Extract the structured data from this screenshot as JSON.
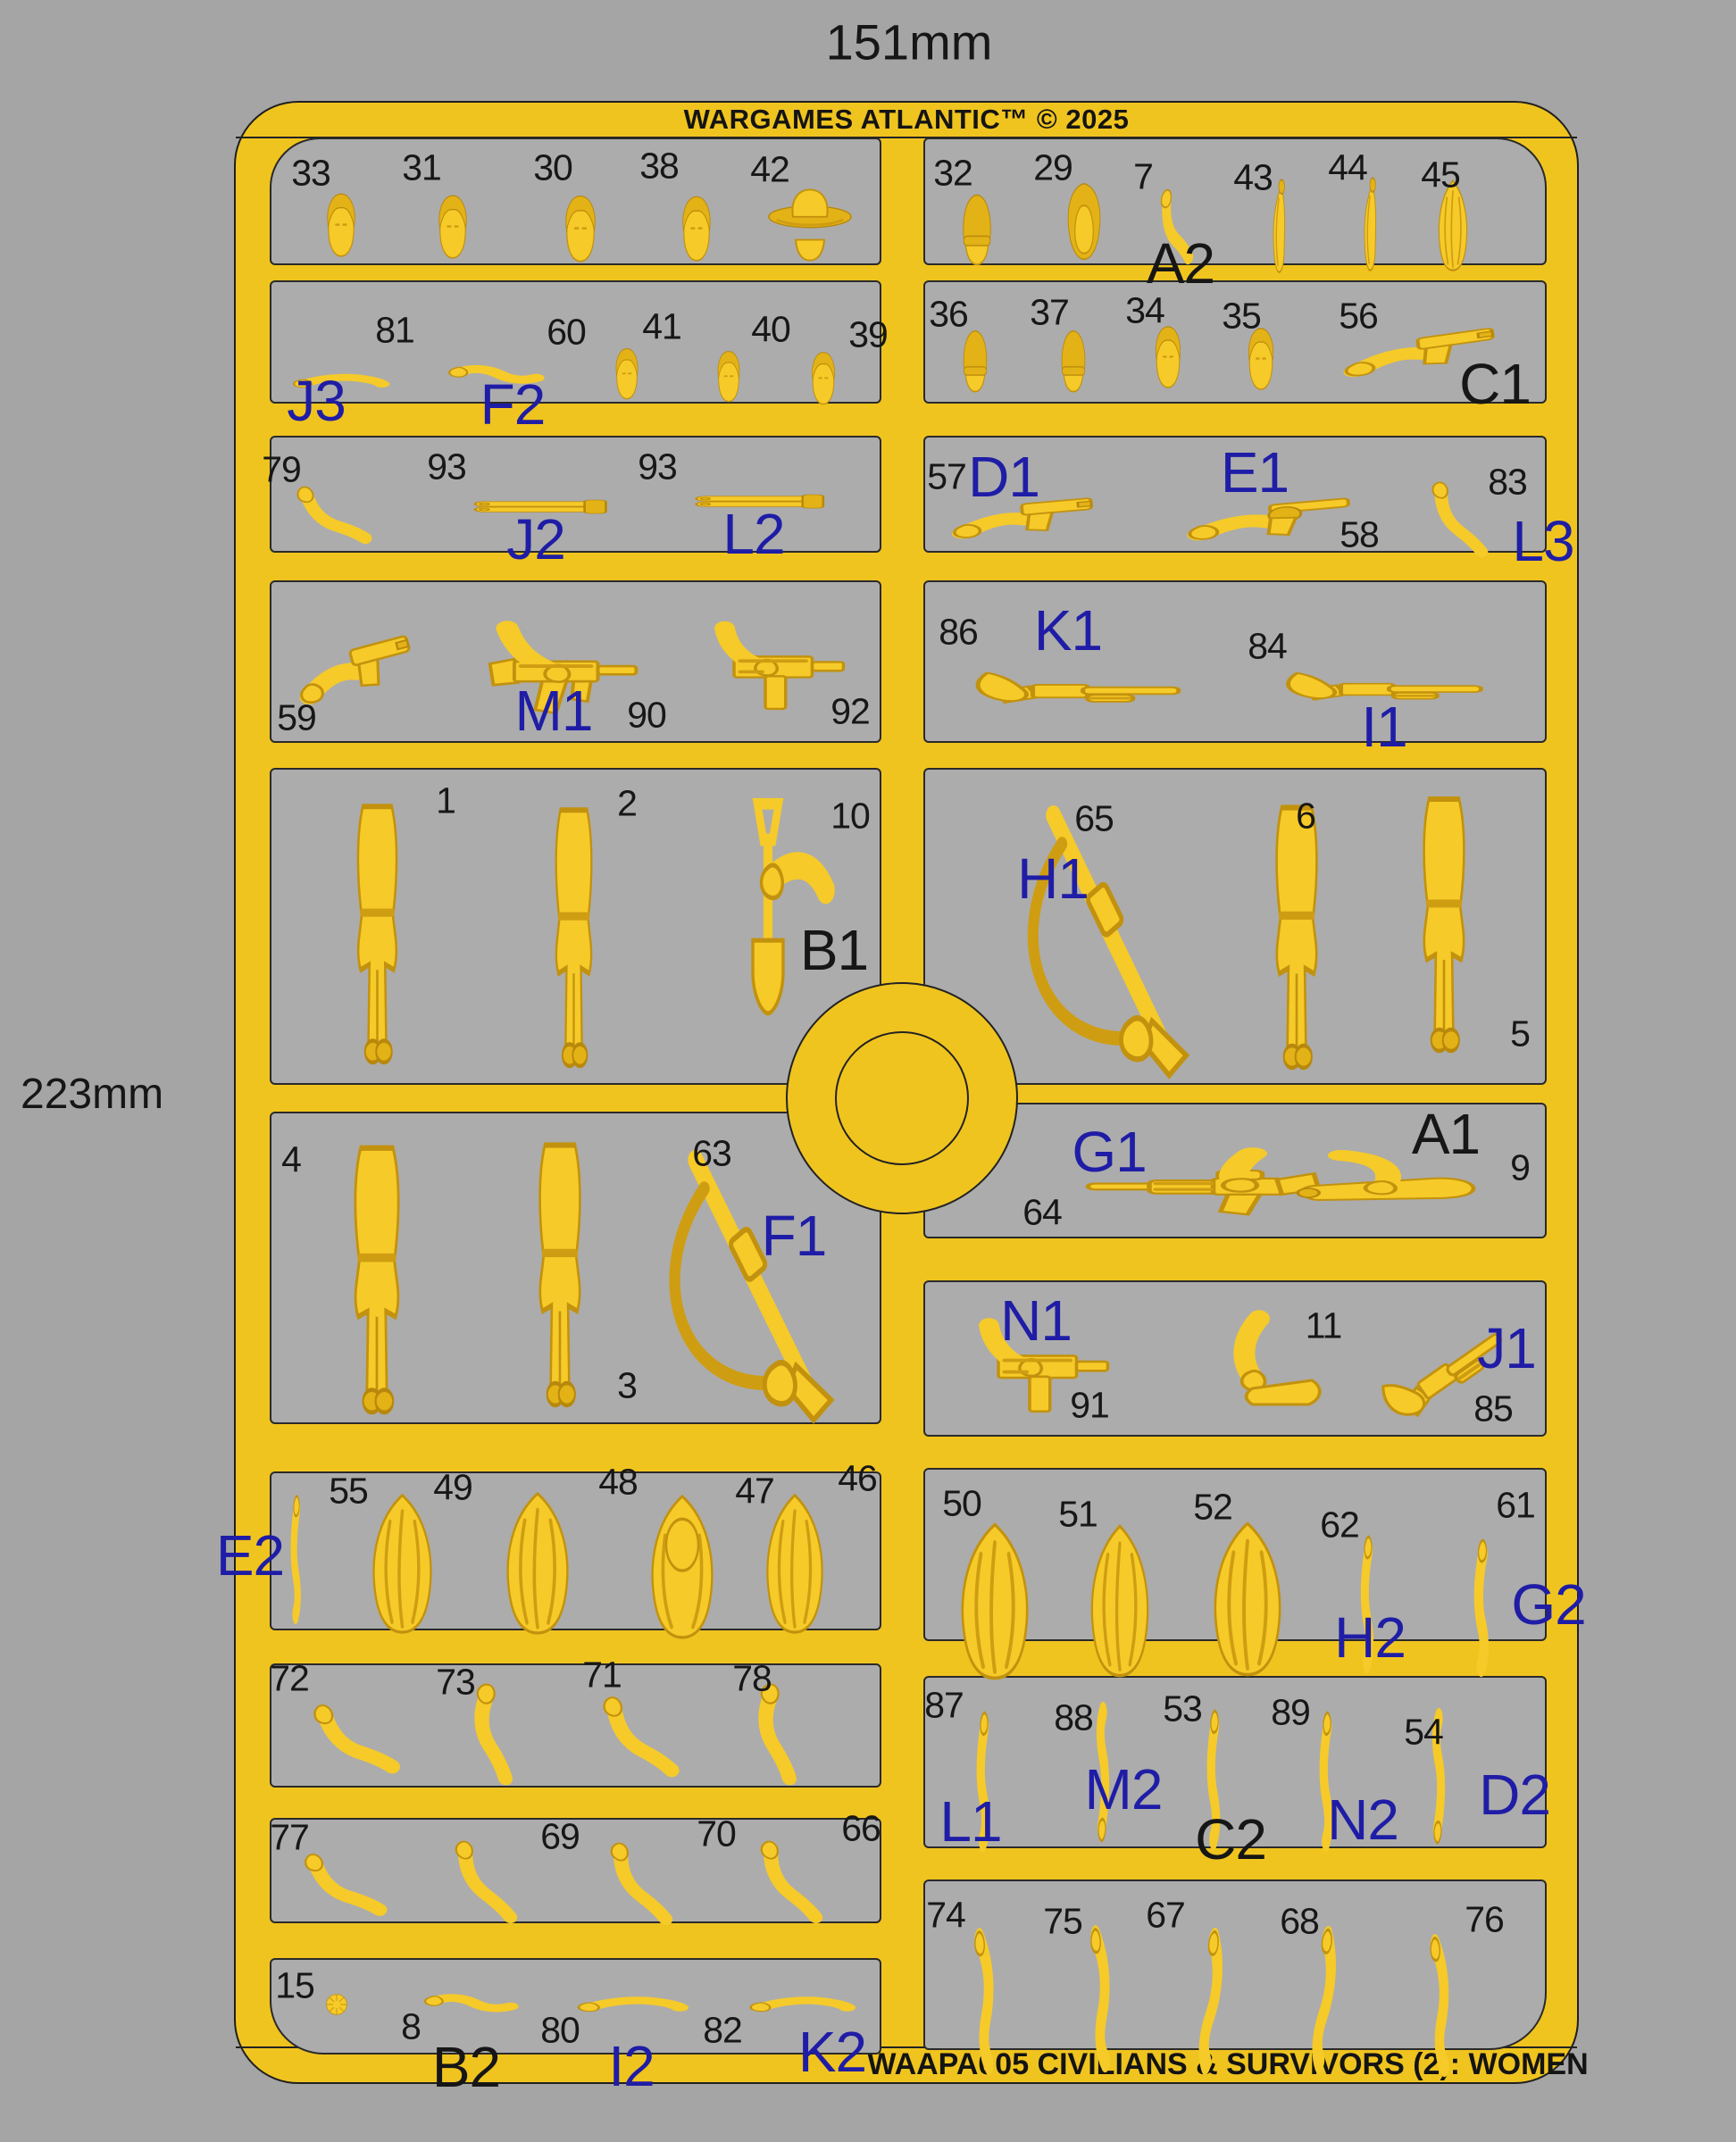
{
  "dimensions": {
    "width": "151mm",
    "height": "223mm"
  },
  "header": {
    "brand": "WARGAMES ATLANTIC™ © 2025"
  },
  "footer": {
    "text": "WAAPA005 CIVILIANS & SURVIVORS (2): WOMEN"
  },
  "colors": {
    "background": "#a5a5a5",
    "panel": "#acacac",
    "sprue_yellow": "#f0c41f",
    "part_yellow": "#f6ca28",
    "label_blue": "#1f1da6",
    "text_black": "#161616"
  },
  "panels": [
    {
      "id": "L1",
      "parts": [
        {
          "number": "33",
          "shape": "head"
        },
        {
          "number": "31",
          "shape": "head"
        },
        {
          "number": "30",
          "shape": "head"
        },
        {
          "number": "38",
          "shape": "head"
        },
        {
          "number": "42",
          "shape": "head-cowboy-hat"
        }
      ],
      "labels": []
    },
    {
      "id": "R1",
      "parts": [
        {
          "number": "32",
          "shape": "head-beanie"
        },
        {
          "number": "29",
          "shape": "head-hood"
        },
        {
          "number": "7",
          "shape": "arm-bent"
        },
        {
          "number": "43",
          "shape": "hair-ponytail"
        },
        {
          "number": "44",
          "shape": "hair-ponytail"
        },
        {
          "number": "45",
          "shape": "hair"
        }
      ],
      "labels": [
        {
          "text": "A2",
          "color": "black"
        }
      ]
    },
    {
      "id": "L2",
      "parts": [
        {
          "number": "81",
          "shape": "arm-straight"
        },
        {
          "number": "60",
          "shape": "arm-bent-side"
        },
        {
          "number": "41",
          "shape": "head"
        },
        {
          "number": "40",
          "shape": "head"
        },
        {
          "number": "39",
          "shape": "head"
        }
      ],
      "labels": [
        {
          "text": "J3",
          "color": "blue"
        },
        {
          "text": "F2",
          "color": "blue"
        }
      ]
    },
    {
      "id": "R2",
      "parts": [
        {
          "number": "36",
          "shape": "head-beanie"
        },
        {
          "number": "37",
          "shape": "head-beanie"
        },
        {
          "number": "34",
          "shape": "head"
        },
        {
          "number": "35",
          "shape": "head"
        },
        {
          "number": "56",
          "shape": "arm-pistol"
        }
      ],
      "labels": [
        {
          "text": "C1",
          "color": "black"
        }
      ]
    },
    {
      "id": "L3",
      "parts": [
        {
          "number": "79",
          "shape": "arm-bent"
        },
        {
          "number": "93",
          "shape": "gun-barrels"
        },
        {
          "number": "93",
          "shape": "gun-barrels"
        }
      ],
      "labels": [
        {
          "text": "J2",
          "color": "blue"
        },
        {
          "text": "L2",
          "color": "blue"
        }
      ]
    },
    {
      "id": "R3",
      "parts": [
        {
          "number": "57",
          "shape": "arm-pistol"
        },
        {
          "number": "58",
          "shape": "arm-revolver"
        },
        {
          "number": "83",
          "shape": "arm-bent"
        }
      ],
      "labels": [
        {
          "text": "D1",
          "color": "blue"
        },
        {
          "text": "E1",
          "color": "blue"
        },
        {
          "text": "L3",
          "color": "blue"
        }
      ]
    },
    {
      "id": "L4",
      "parts": [
        {
          "number": "59",
          "shape": "arm-pistol"
        },
        {
          "number": "90",
          "shape": "arm-smg"
        },
        {
          "number": "92",
          "shape": "arm-uzi"
        }
      ],
      "labels": [
        {
          "text": "M1",
          "color": "blue"
        }
      ]
    },
    {
      "id": "R4",
      "parts": [
        {
          "number": "86",
          "shape": "arm-shotgun"
        },
        {
          "number": "84",
          "shape": "arm-shotgun"
        }
      ],
      "labels": [
        {
          "text": "K1",
          "color": "blue"
        },
        {
          "text": "I1",
          "color": "blue"
        }
      ]
    },
    {
      "id": "L5",
      "parts": [
        {
          "number": "1",
          "shape": "body-inverted"
        },
        {
          "number": "2",
          "shape": "body"
        },
        {
          "number": "10",
          "shape": "arm-shovel"
        }
      ],
      "labels": [
        {
          "text": "B1",
          "color": "black"
        }
      ]
    },
    {
      "id": "R5",
      "parts": [
        {
          "number": "65",
          "shape": "rifle-sling"
        },
        {
          "number": "6",
          "shape": "body"
        },
        {
          "number": "5",
          "shape": "body-inverted"
        }
      ],
      "labels": [
        {
          "text": "H1",
          "color": "blue"
        }
      ]
    },
    {
      "id": "L6",
      "parts": [
        {
          "number": "4",
          "shape": "body"
        },
        {
          "number": "3",
          "shape": "body-inverted"
        },
        {
          "number": "63",
          "shape": "rifle-sling"
        }
      ],
      "labels": [
        {
          "text": "F1",
          "color": "blue"
        }
      ]
    },
    {
      "id": "R6a",
      "parts": [
        {
          "number": "64",
          "shape": "arm-rifle"
        },
        {
          "number": "9",
          "shape": "arm-bat"
        }
      ],
      "labels": [
        {
          "text": "G1",
          "color": "blue"
        },
        {
          "text": "A1",
          "color": "black"
        }
      ]
    },
    {
      "id": "R6b",
      "parts": [
        {
          "number": "91",
          "shape": "arm-uzi"
        },
        {
          "number": "11",
          "shape": "arm-machete"
        },
        {
          "number": "85",
          "shape": "arm-shotgun"
        }
      ],
      "labels": [
        {
          "text": "N1",
          "color": "blue"
        },
        {
          "text": "J1",
          "color": "blue"
        }
      ]
    },
    {
      "id": "L7",
      "parts": [
        {
          "number": "55",
          "shape": "arm-raised"
        },
        {
          "number": "49",
          "shape": "hair"
        },
        {
          "number": "48",
          "shape": "hair"
        },
        {
          "number": "47",
          "shape": "hair-face"
        },
        {
          "number": "46",
          "shape": "hair"
        }
      ],
      "labels": [
        {
          "text": "E2",
          "color": "blue"
        }
      ]
    },
    {
      "id": "R7",
      "parts": [
        {
          "number": "50",
          "shape": "hair"
        },
        {
          "number": "51",
          "shape": "hair"
        },
        {
          "number": "52",
          "shape": "hair"
        },
        {
          "number": "62",
          "shape": "arm-raised"
        },
        {
          "number": "61",
          "shape": "arm-raised"
        }
      ],
      "labels": [
        {
          "text": "H2",
          "color": "blue"
        },
        {
          "text": "G2",
          "color": "blue"
        }
      ]
    },
    {
      "id": "L8",
      "parts": [
        {
          "number": "72",
          "shape": "arm-bent"
        },
        {
          "number": "73",
          "shape": "arm-bent"
        },
        {
          "number": "71",
          "shape": "arm-bent"
        },
        {
          "number": "78",
          "shape": "arm-bent"
        }
      ],
      "labels": []
    },
    {
      "id": "R8",
      "parts": [
        {
          "number": "87",
          "shape": "arm-raised"
        },
        {
          "number": "88",
          "shape": "arm-raised"
        },
        {
          "number": "53",
          "shape": "arm-raised"
        },
        {
          "number": "89",
          "shape": "arm-raised"
        },
        {
          "number": "54",
          "shape": "arm-raised"
        }
      ],
      "labels": [
        {
          "text": "L1",
          "color": "blue"
        },
        {
          "text": "M2",
          "color": "blue"
        },
        {
          "text": "C2",
          "color": "black"
        },
        {
          "text": "N2",
          "color": "blue"
        },
        {
          "text": "D2",
          "color": "blue"
        }
      ]
    },
    {
      "id": "L9",
      "parts": [
        {
          "number": "77",
          "shape": "arm-bent"
        },
        {
          "number": "69",
          "shape": "arm-bent"
        },
        {
          "number": "70",
          "shape": "arm-bent"
        },
        {
          "number": "66",
          "shape": "arm-bent"
        }
      ],
      "labels": []
    },
    {
      "id": "R9",
      "parts": [
        {
          "number": "74",
          "shape": "arm-long"
        },
        {
          "number": "75",
          "shape": "arm-long"
        },
        {
          "number": "67",
          "shape": "arm-long"
        },
        {
          "number": "68",
          "shape": "arm-long"
        },
        {
          "number": "76",
          "shape": "arm-long"
        }
      ],
      "labels": []
    },
    {
      "id": "L10",
      "parts": [
        {
          "number": "15",
          "shape": "hair-bun"
        },
        {
          "number": "8",
          "shape": "arm-bent-side"
        },
        {
          "number": "80",
          "shape": "arm-straight"
        },
        {
          "number": "82",
          "shape": "arm-straight"
        }
      ],
      "labels": [
        {
          "text": "B2",
          "color": "black"
        },
        {
          "text": "I2",
          "color": "blue"
        },
        {
          "text": "K2",
          "color": "blue"
        }
      ]
    }
  ]
}
